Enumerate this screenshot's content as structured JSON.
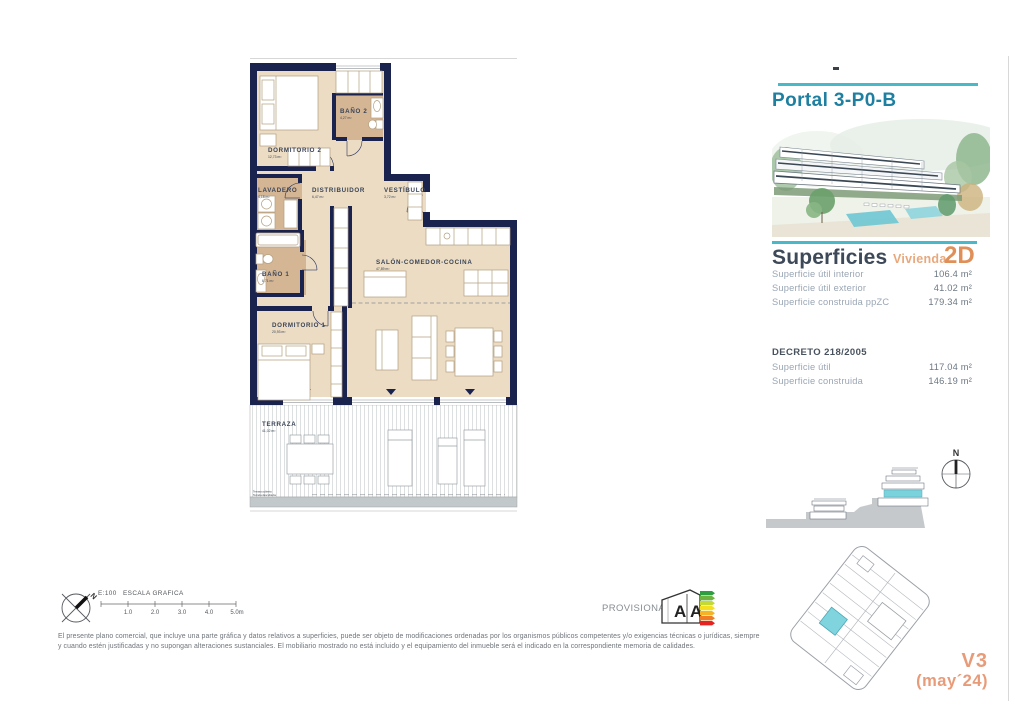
{
  "header": {
    "portal": "Portal 3-P0-B"
  },
  "superficies": {
    "title": "Superficies",
    "vivienda_label": "Vivienda",
    "vivienda_code": "2D",
    "rows": [
      {
        "label": "Superficie útil interior",
        "value": "106.4 m²"
      },
      {
        "label": "Superficie útil exterior",
        "value": "41.02 m²"
      },
      {
        "label": "Superficie construida ppZC",
        "value": "179.34 m²"
      }
    ]
  },
  "decreto": {
    "title": "DECRETO 218/2005",
    "rows": [
      {
        "label": "Superficie útil",
        "value": "117.04 m²"
      },
      {
        "label": "Superficie construida",
        "value": "146.19 m²"
      }
    ]
  },
  "plan": {
    "rooms": {
      "dormitorio2": {
        "name": "DORMITORIO 2",
        "area": "12,73 m²"
      },
      "bano2": {
        "name": "BAÑO 2",
        "area": "4,27 m²"
      },
      "lavadero": {
        "name": "LAVADERO",
        "area": "4,18 m²"
      },
      "distribuidor": {
        "name": "DISTRIBUIDOR",
        "area": "6,47 m²"
      },
      "vestibulo": {
        "name": "VESTÍBULO",
        "area": "3,72 m²"
      },
      "bano1": {
        "name": "BAÑO 1",
        "area": "6,71 m²"
      },
      "salon": {
        "name": "SALÓN-COMEDOR-COCINA",
        "area": "47,89 m²"
      },
      "dormitorio1": {
        "name": "DORMITORIO 1",
        "area": "20,93 m²"
      },
      "terraza": {
        "name": "TERRAZA",
        "area": "41,02 m²"
      }
    },
    "terraza_notes": {
      "line1": "Terraza cubierta",
      "line2": "Terraza descubierta"
    }
  },
  "scalebar": {
    "ratio": "E:100",
    "label": "ESCALA GRAFICA",
    "ticks": [
      "1.0",
      "2.0",
      "3.0",
      "4.0",
      "5.0m"
    ],
    "north": "N"
  },
  "section": {
    "north": "N"
  },
  "energy": {
    "status": "PROVISIONAL",
    "letter1": "A",
    "letter2": "A"
  },
  "version": {
    "line1": "V3",
    "line2": "(may´24)"
  },
  "disclaimer": "El presente plano comercial, que incluye una parte gráfica y datos relativos a superficies, puede ser objeto de modificaciones ordenadas por los organismos públicos competentes y/o exigencias técnicas o jurídicas, siempre y cuando estén justificadas y no supongan alteraciones sustanciales. El mobiliario mostrado no está incluido y el equipamiento del inmueble será el indicado en la correspondiente memoria de calidades.",
  "colors": {
    "accent_teal": "#49b8c8",
    "heading_teal": "#1f7fa0",
    "accent_orange": "#e59a70",
    "wall_navy": "#1a234e",
    "floor_beige": "#ebdcc3",
    "wet_room_tan": "#d5b694",
    "highlight_teal": "#7fd4dd"
  }
}
